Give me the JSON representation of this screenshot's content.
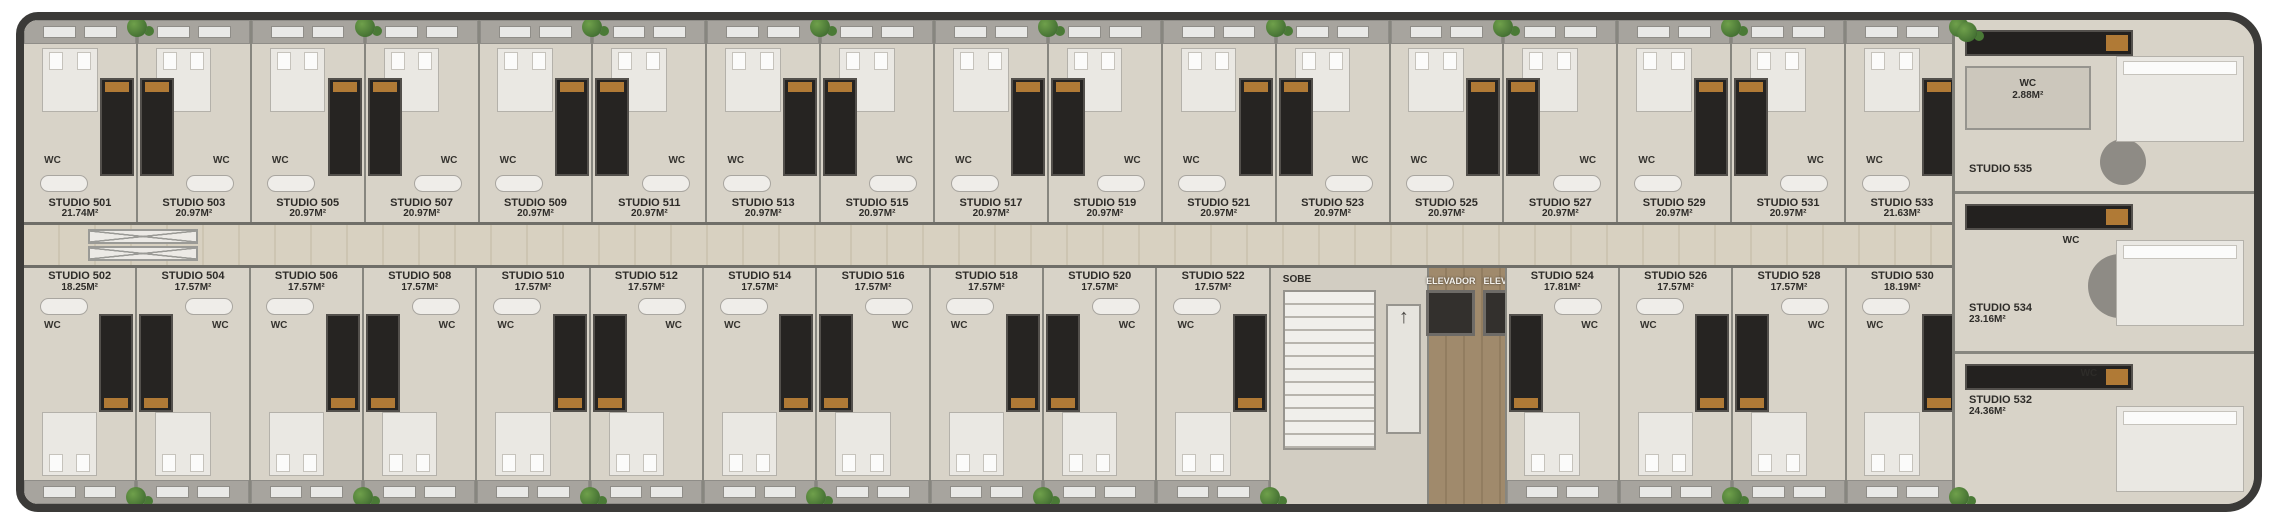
{
  "labels": {
    "wc": "WC"
  },
  "icons": {
    "up_arrow": "↑",
    "plant": "potted-plant",
    "shaft": "crossed-shaft-marker"
  },
  "core": {
    "stairs_label": "SOBE",
    "elevators": [
      "ELEVADOR",
      "ELEVADOR"
    ]
  },
  "top_row": [
    {
      "name": "STUDIO 501",
      "area": "21.74M²"
    },
    {
      "name": "STUDIO 503",
      "area": "20.97M²"
    },
    {
      "name": "STUDIO 505",
      "area": "20.97M²"
    },
    {
      "name": "STUDIO 507",
      "area": "20.97M²"
    },
    {
      "name": "STUDIO 509",
      "area": "20.97M²"
    },
    {
      "name": "STUDIO 511",
      "area": "20.97M²"
    },
    {
      "name": "STUDIO 513",
      "area": "20.97M²"
    },
    {
      "name": "STUDIO 515",
      "area": "20.97M²"
    },
    {
      "name": "STUDIO 517",
      "area": "20.97M²"
    },
    {
      "name": "STUDIO 519",
      "area": "20.97M²"
    },
    {
      "name": "STUDIO 521",
      "area": "20.97M²"
    },
    {
      "name": "STUDIO 523",
      "area": "20.97M²"
    },
    {
      "name": "STUDIO 525",
      "area": "20.97M²"
    },
    {
      "name": "STUDIO 527",
      "area": "20.97M²"
    },
    {
      "name": "STUDIO 529",
      "area": "20.97M²"
    },
    {
      "name": "STUDIO 531",
      "area": "20.97M²"
    },
    {
      "name": "STUDIO 533",
      "area": "21.63M²"
    }
  ],
  "bottom_row": [
    {
      "name": "STUDIO 502",
      "area": "18.25M²"
    },
    {
      "name": "STUDIO 504",
      "area": "17.57M²"
    },
    {
      "name": "STUDIO 506",
      "area": "17.57M²"
    },
    {
      "name": "STUDIO 508",
      "area": "17.57M²"
    },
    {
      "name": "STUDIO 510",
      "area": "17.57M²"
    },
    {
      "name": "STUDIO 512",
      "area": "17.57M²"
    },
    {
      "name": "STUDIO 514",
      "area": "17.57M²"
    },
    {
      "name": "STUDIO 516",
      "area": "17.57M²"
    },
    {
      "name": "STUDIO 518",
      "area": "17.57M²"
    },
    {
      "name": "STUDIO 520",
      "area": "17.57M²"
    },
    {
      "name": "STUDIO 522",
      "area": "17.57M²"
    },
    {
      "name": "STUDIO 524",
      "area": "17.81M²"
    },
    {
      "name": "STUDIO 526",
      "area": "17.57M²"
    },
    {
      "name": "STUDIO 528",
      "area": "17.57M²"
    },
    {
      "name": "STUDIO 530",
      "area": "18.19M²"
    }
  ],
  "right_units": [
    {
      "name": "STUDIO 535",
      "wc_name": "WC",
      "wc_area": "2.88M²"
    },
    {
      "name": "STUDIO 534",
      "area": "23.16M²"
    },
    {
      "name": "STUDIO 532",
      "area": "24.36M²"
    }
  ]
}
